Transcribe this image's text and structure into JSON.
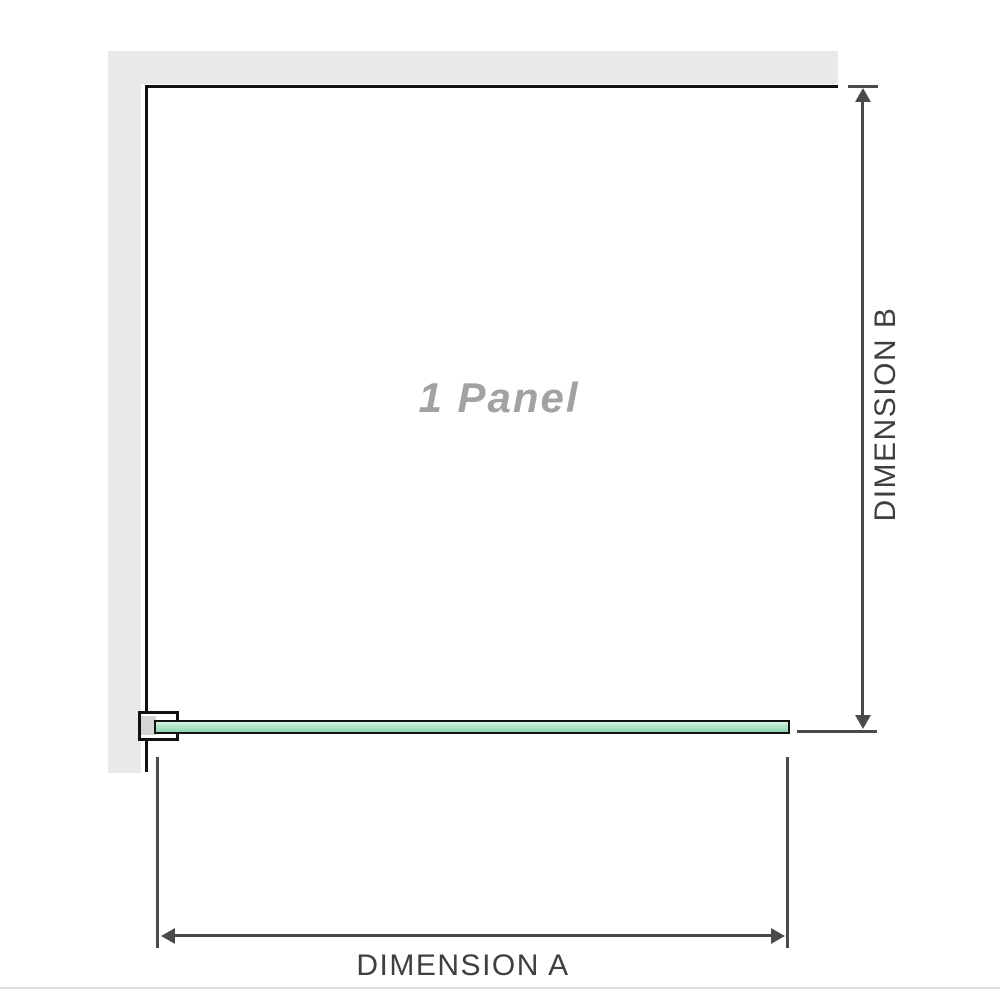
{
  "diagram": {
    "panel_label": "1 Panel",
    "dimension_a": {
      "label": "DIMENSION A"
    },
    "dimension_b": {
      "label": "DIMENSION B"
    }
  },
  "colors": {
    "wall": "#e9e9e9",
    "outline": "#111111",
    "dim_line": "#4a4a4a",
    "label_text": "#3f3f3f",
    "panel_label_text": "#a2a2a2",
    "glass_light": "#ddf3e8",
    "glass_mid": "#b2e4c9",
    "glass_dark": "#93d4b2",
    "bracket_inner": "#d6d6d6",
    "bottom_rule": "#e4e1dc"
  }
}
